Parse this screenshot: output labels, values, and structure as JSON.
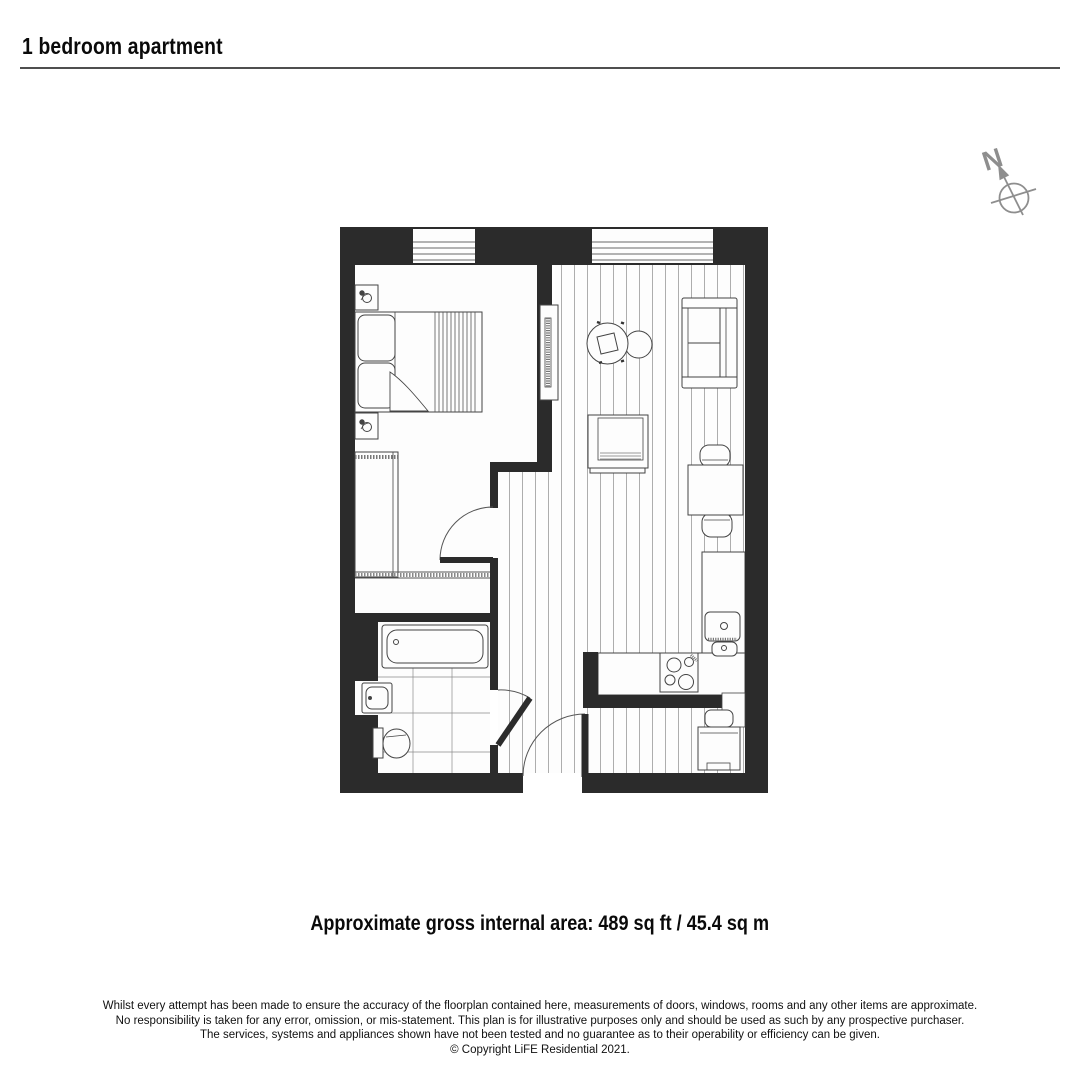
{
  "header": {
    "title": "1 bedroom apartment"
  },
  "compass": {
    "label": "N"
  },
  "area": {
    "label": "Approximate gross internal area: 489 sq ft / 45.4 sq m"
  },
  "disclaimer": {
    "lines": [
      "Whilst every attempt has been made to ensure the accuracy of the floorplan contained here, measurements of doors, windows, rooms and any other items are approximate.",
      "No responsibility is taken for any error, omission, or mis-statement. This plan is for illustrative purposes only and should be used as such by any prospective purchaser.",
      "The services, systems and appliances shown have not been tested and no guarantee as to their operability or efficiency can be given.",
      "© Copyright LiFE Residential 2021."
    ]
  },
  "colors": {
    "wall": "#2b2b2b",
    "furniture_line": "#444444",
    "floor": "#fdfdfd",
    "plank_line": "#999999",
    "compass_gray": "#8e8e8e",
    "rule_gray": "#4f4f4f"
  }
}
